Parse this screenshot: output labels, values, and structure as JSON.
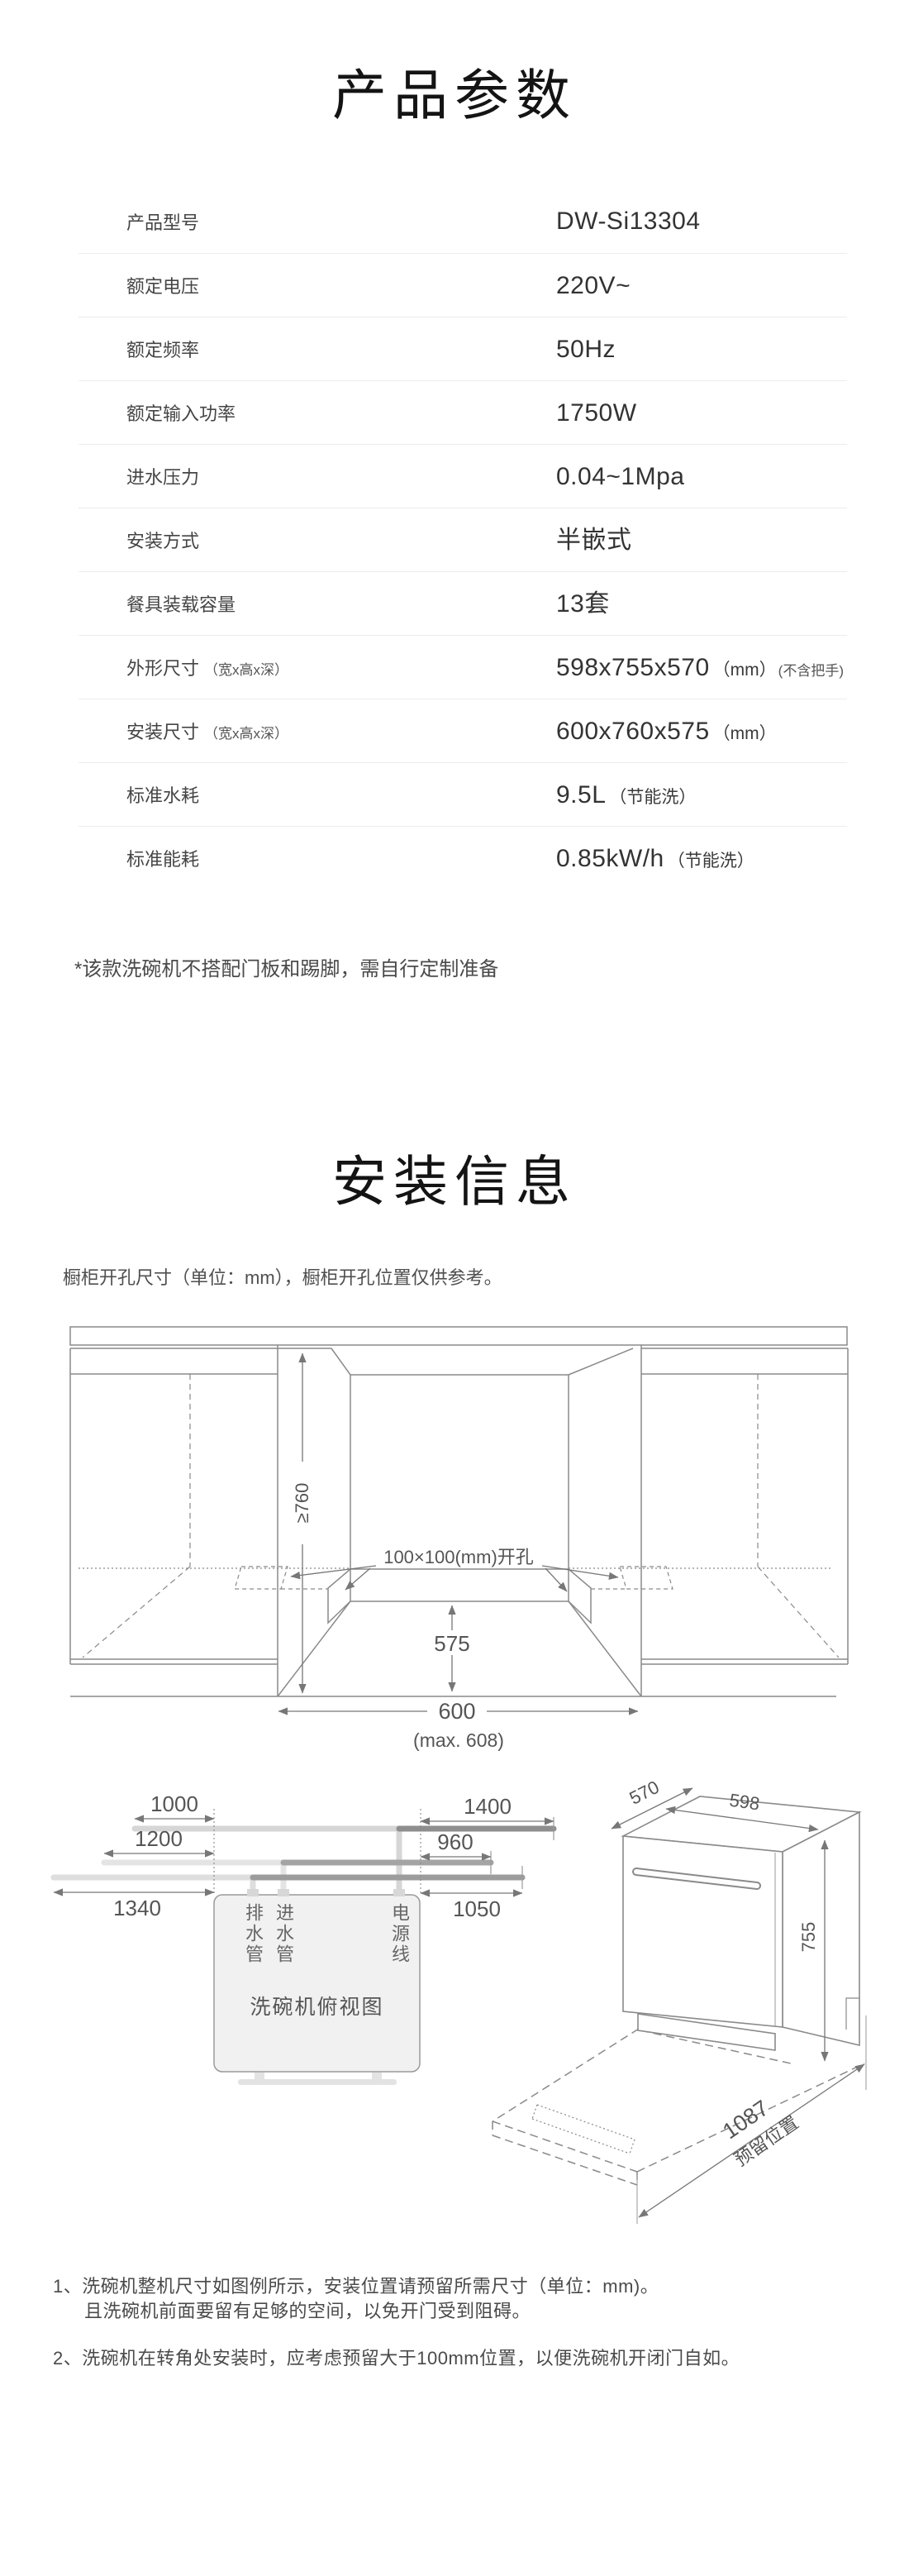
{
  "product": {
    "title": "产品参数",
    "rows": [
      {
        "label": "产品型号",
        "label_note": "",
        "value": "DW-Si13304",
        "value_unit": "",
        "value_note": ""
      },
      {
        "label": "额定电压",
        "label_note": "",
        "value": "220V~",
        "value_unit": "",
        "value_note": ""
      },
      {
        "label": "额定频率",
        "label_note": "",
        "value": "50Hz",
        "value_unit": "",
        "value_note": ""
      },
      {
        "label": "额定输入功率",
        "label_note": "",
        "value": "1750W",
        "value_unit": "",
        "value_note": ""
      },
      {
        "label": "进水压力",
        "label_note": "",
        "value": "0.04~1Mpa",
        "value_unit": "",
        "value_note": ""
      },
      {
        "label": "安装方式",
        "label_note": "",
        "value": "半嵌式",
        "value_unit": "",
        "value_note": ""
      },
      {
        "label": "餐具装载容量",
        "label_note": "",
        "value": "13套",
        "value_unit": "",
        "value_note": ""
      },
      {
        "label": "外形尺寸",
        "label_note": "（宽x高x深）",
        "value": "598x755x570",
        "value_unit": "（mm）",
        "value_note": "(不含把手)"
      },
      {
        "label": "安装尺寸",
        "label_note": "（宽x高x深）",
        "value": "600x760x575",
        "value_unit": "（mm）",
        "value_note": ""
      },
      {
        "label": "标准水耗",
        "label_note": "",
        "value": "9.5L",
        "value_unit": "（节能洗）",
        "value_note": ""
      },
      {
        "label": "标准能耗",
        "label_note": "",
        "value": "0.85kW/h",
        "value_unit": "（节能洗）",
        "value_note": ""
      }
    ],
    "footnote": "*该款洗碗机不搭配门板和踢脚，需自行定制准备"
  },
  "install": {
    "title": "安装信息",
    "intro": "橱柜开孔尺寸（单位：mm），橱柜开孔位置仅供参考。",
    "cabinet": {
      "height": "≥760",
      "hole": "100×100(mm)开孔",
      "depth": "575",
      "width": "600",
      "width_max": "(max. 608)"
    },
    "topview": {
      "d1000": "1000",
      "d1200": "1200",
      "d1340": "1340",
      "d1400": "1400",
      "d960": "960",
      "d1050": "1050",
      "drain": "排水管",
      "inlet": "进水管",
      "power": "电源线",
      "caption": "洗碗机俯视图"
    },
    "iso": {
      "depth": "570",
      "width": "598",
      "height": "755",
      "reserve": "1087",
      "reserve_label": "预留位置"
    },
    "notes": [
      "1、洗碗机整机尺寸如图例所示，安装位置请预留所需尺寸（单位：mm)。",
      "且洗碗机前面要留有足够的空间，以免开门受到阻碍。",
      "2、洗碗机在转角处安装时，应考虑预留大于100mm位置，以便洗碗机开闭门自如。"
    ]
  }
}
